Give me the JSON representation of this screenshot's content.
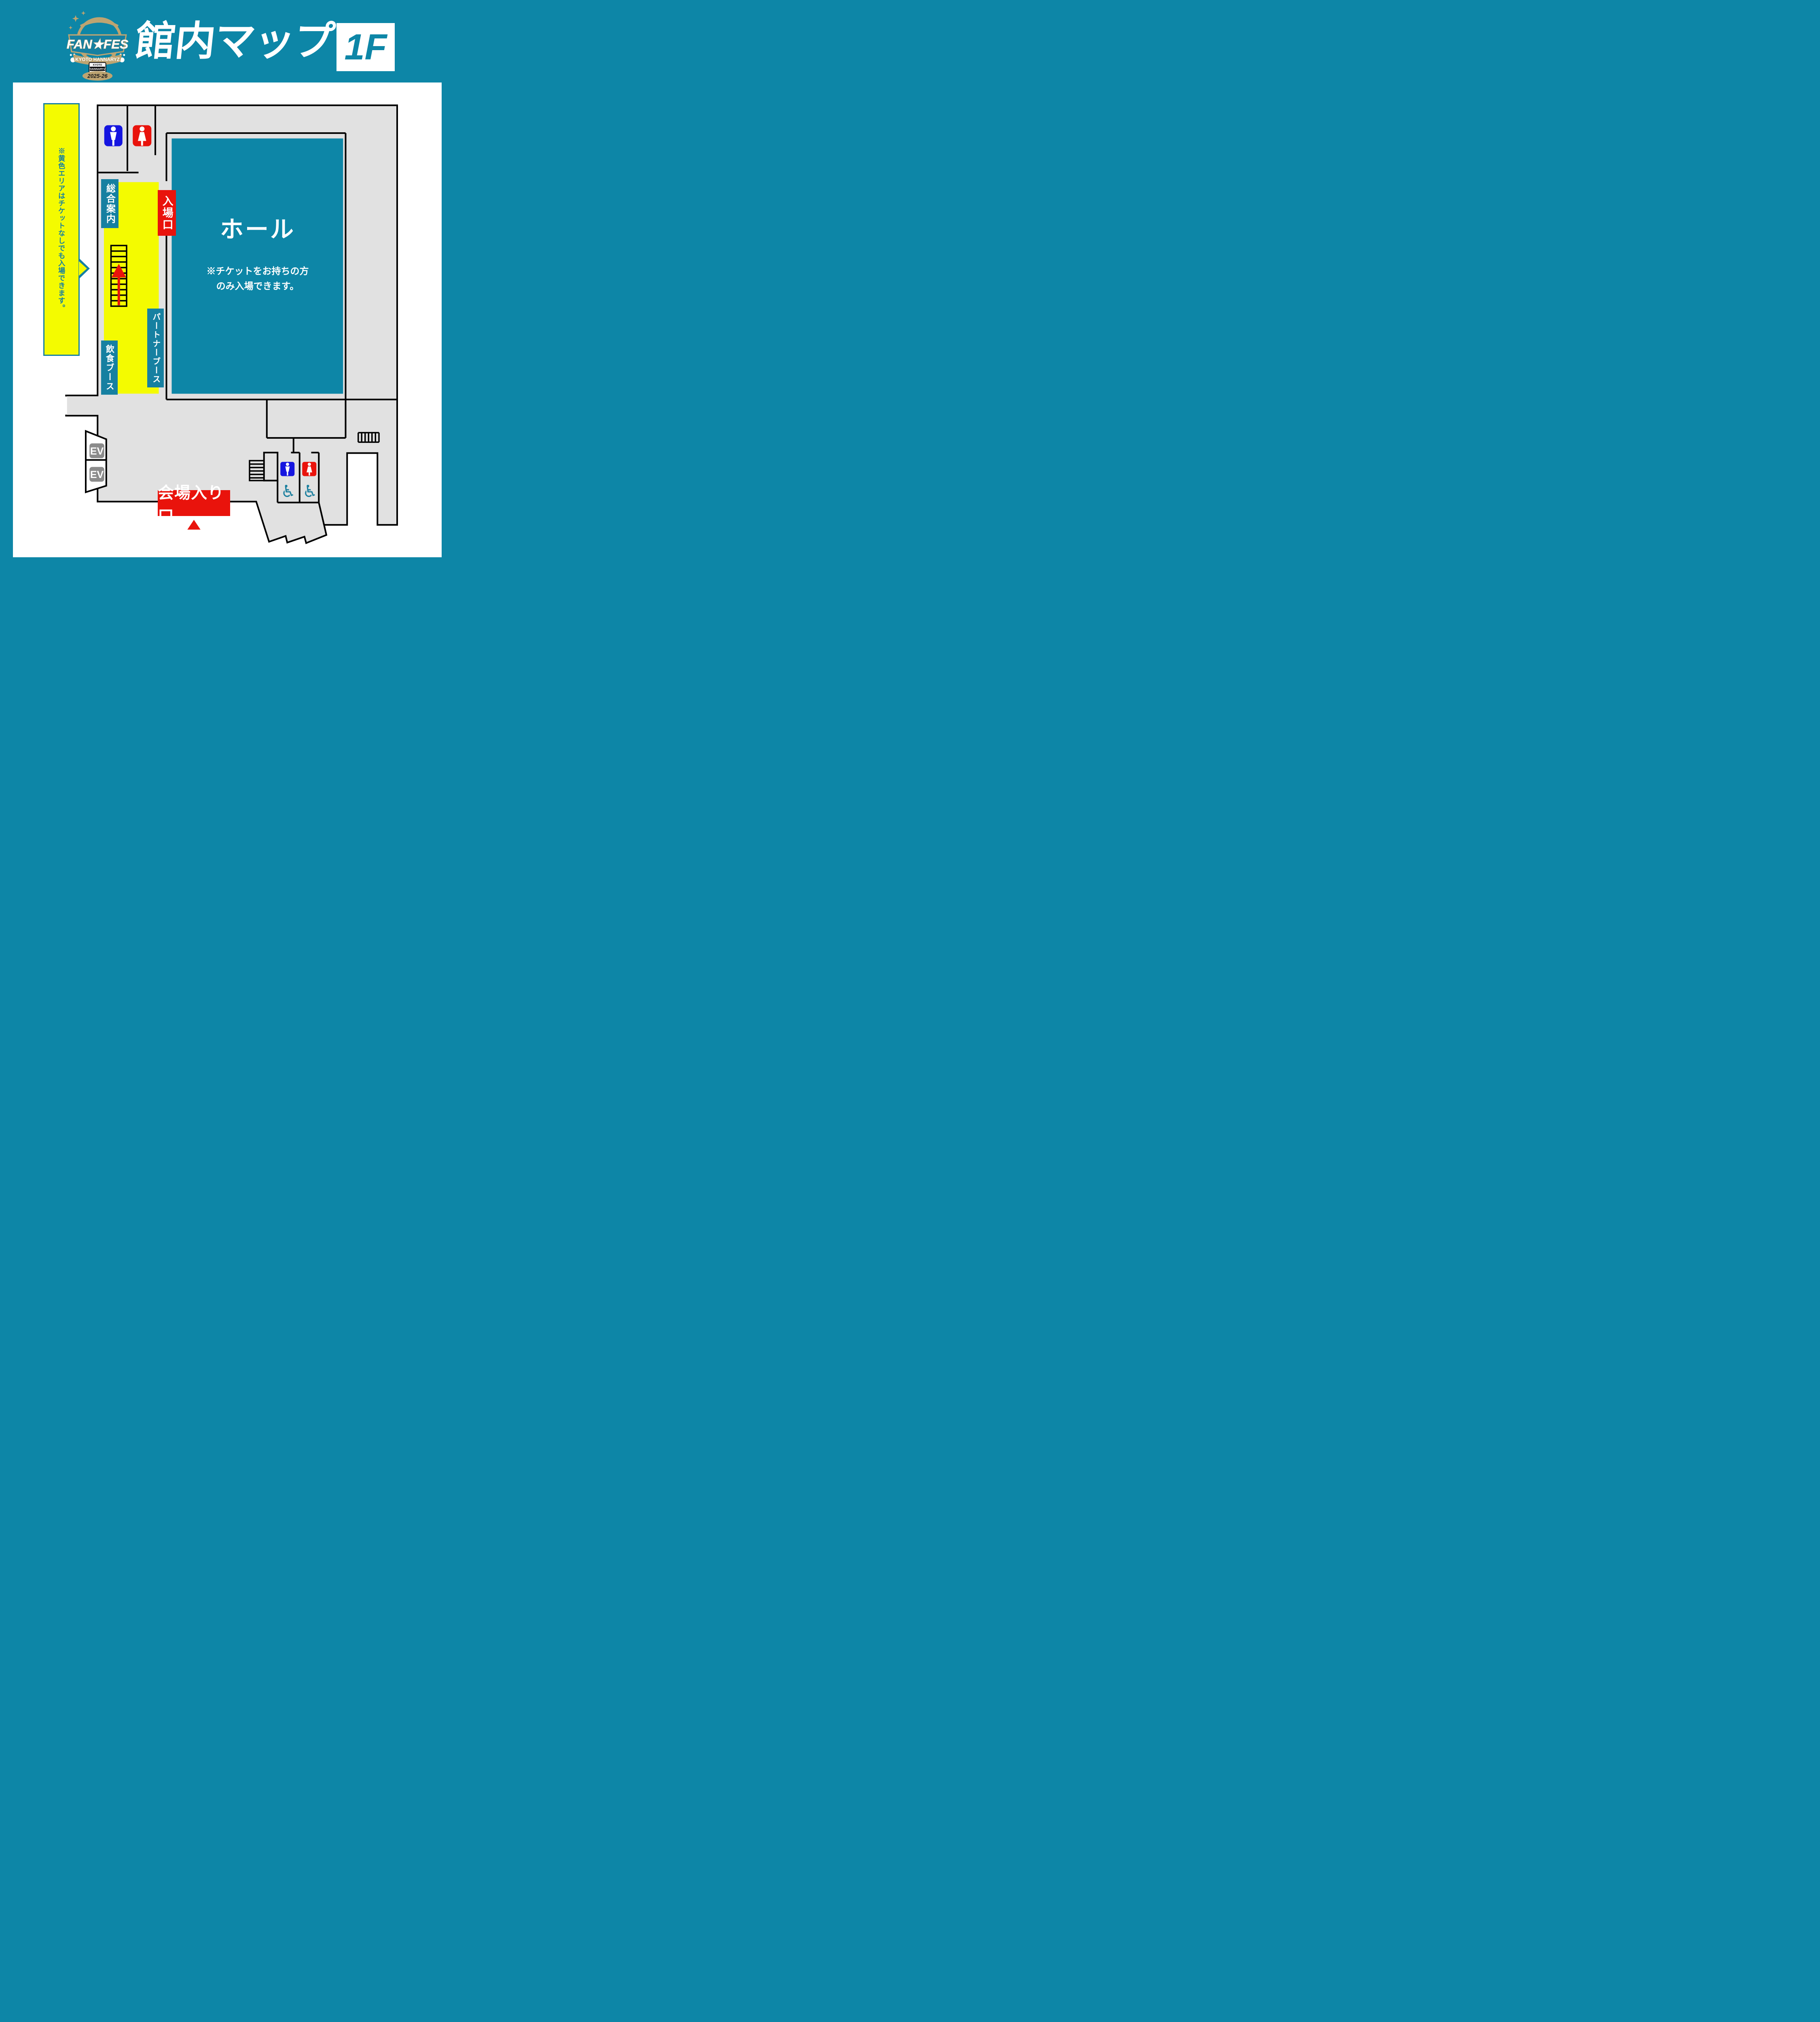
{
  "header": {
    "title": "館内マップ",
    "floor_badge": "1F",
    "logo": {
      "fan_fes": "FAN★FES",
      "kyoto_hannaryz": "KYOTO HANNARYZ",
      "badge_kyoto": "KYOTO",
      "badge_hannaryz": "HANNARYZ",
      "season": "2025-26"
    }
  },
  "callout": {
    "text": "※黄色エリアはチケットなしでも入場できます。"
  },
  "map": {
    "info_label": "総合案内",
    "entrance_gate_label": "入場口",
    "hall_label": "ホール",
    "hall_note_line1": "※チケットをお持ちの方",
    "hall_note_line2": "のみ入場できます。",
    "partner_booth_label": "パートナーブース",
    "food_booth_label": "飲食ブース",
    "venue_entrance_label": "会場入り口",
    "ev_label": "EV",
    "wheelchair_symbol": "♿"
  },
  "colors": {
    "teal_background": "#0d86a7",
    "label_teal": "#1680a1",
    "ticket_free_yellow": "#f4fb00",
    "alert_red": "#e9130c",
    "male_blue": "#1515e0",
    "floor_gray": "#e1e1e1",
    "wall_black": "#000000",
    "accessible_teal": "#1b7f9e",
    "elevator_gray": "#8b8b8b",
    "logo_gold": "#bda471"
  }
}
